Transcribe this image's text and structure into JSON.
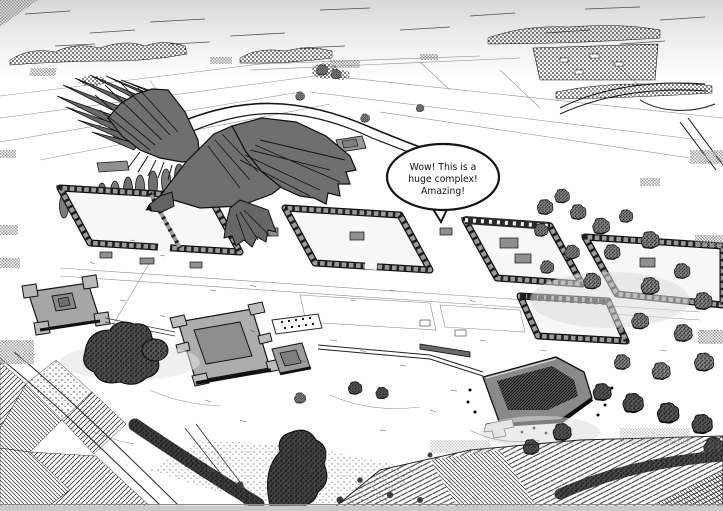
{
  "panel": {
    "type": "black-and-white comic illustration",
    "subject": "aerial bird's-eye view of a huge ancient ruin complex with an eagle flying over it"
  },
  "speech_bubble": {
    "line1": "Wow! This is a",
    "line2": "huge complex!",
    "line3": "Amazing!",
    "full_text": "Wow! This is a huge complex! Amazing!"
  },
  "palette": {
    "paper": "#ffffff",
    "ink": "#141414",
    "eagle_gray": "#6f6f6f",
    "wall_gray": "#9a9a9a",
    "platform_gray": "#adadad",
    "tree_gray": "#828282",
    "dark_tree_gray": "#4e4e4e",
    "sky_gray": "#d7d7d7",
    "screentone_gray": "#8f8f8f",
    "page_edge_gray": "#c9c9c9"
  },
  "scene_elements": [
    "sky",
    "horizon-treeline",
    "distant-village",
    "country-roads",
    "poplar-row",
    "ruin-enclosures",
    "central-platform",
    "corner-fort",
    "pyramid-mound",
    "tree-clusters",
    "farm-fields",
    "eagle",
    "speech-bubble"
  ]
}
